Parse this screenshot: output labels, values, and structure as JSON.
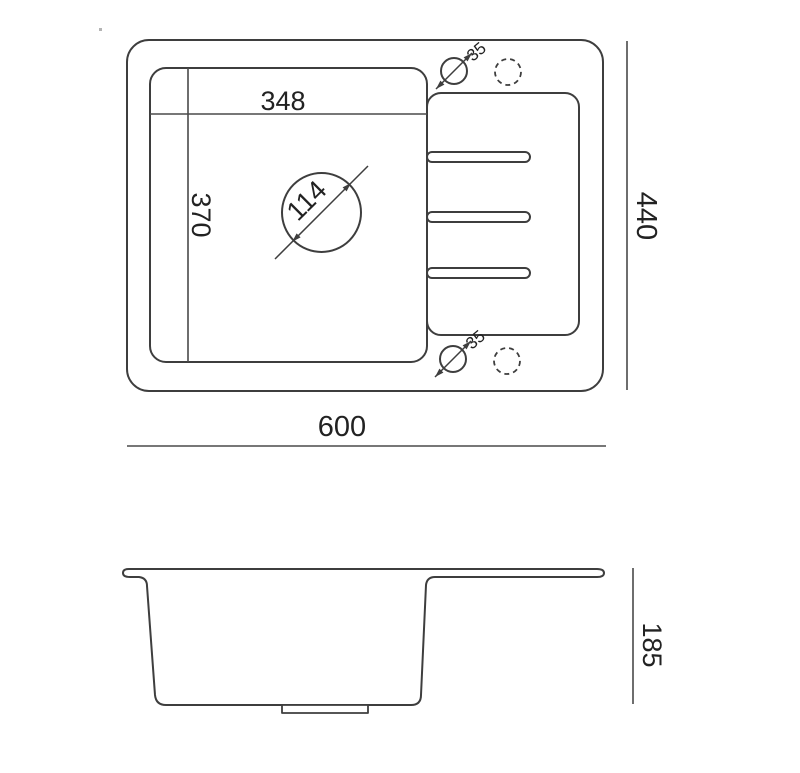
{
  "drawing": {
    "subject": "Kitchen sink with drainboard - technical drawing (top view and side section)",
    "colors": {
      "background": "#ffffff",
      "line": "#3e3e3e",
      "dimension_line": "#4a4a4a",
      "text": "#222222"
    },
    "top_view": {
      "bowl_width": "348",
      "bowl_depth": "370",
      "drain_diameter": "114",
      "tap_hole_diameter_top": "35",
      "tap_hole_diameter_bottom": "35",
      "overall_width": "600",
      "overall_depth": "440"
    },
    "side_view": {
      "overall_height": "185"
    }
  }
}
